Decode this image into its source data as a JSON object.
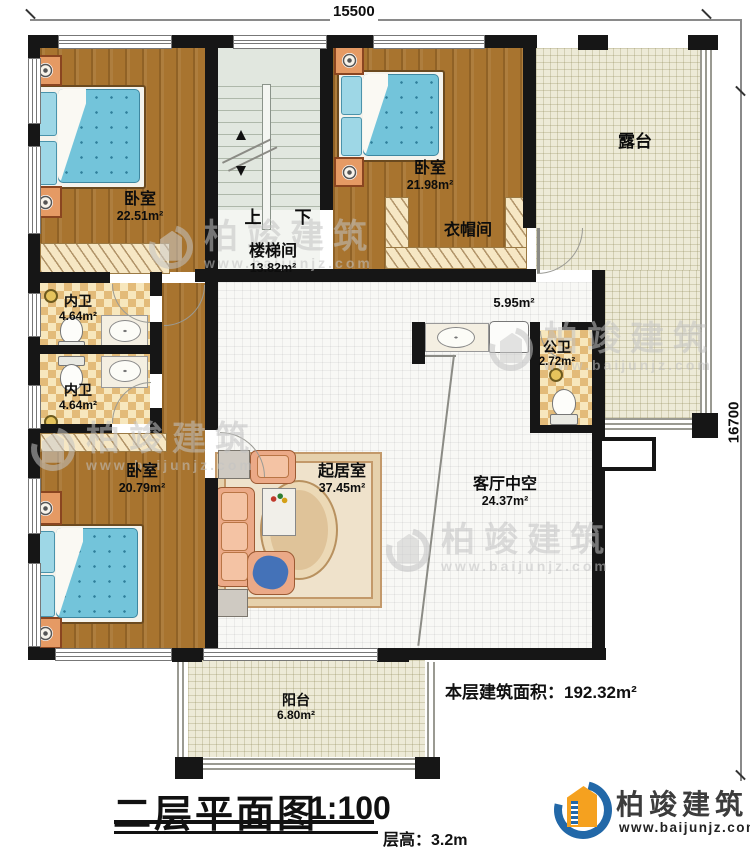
{
  "dimensions": {
    "top": "15500",
    "right": "16700"
  },
  "rooms": {
    "bedroom_tl": {
      "name": "卧室",
      "area": "22.51m²"
    },
    "bedroom_tr": {
      "name": "卧室",
      "area": "21.98m²"
    },
    "closet": {
      "name": "衣帽间"
    },
    "stairwell": {
      "name": "楼梯间",
      "area": "13.82m²",
      "up": "上",
      "down": "下"
    },
    "terrace": {
      "name": "露台"
    },
    "hall": {
      "area": "5.95m²"
    },
    "public_bath": {
      "name": "公卫",
      "area": "2.72m²"
    },
    "bath_1": {
      "name": "内卫",
      "area": "4.64m²"
    },
    "bath_2": {
      "name": "内卫",
      "area": "4.64m²"
    },
    "bedroom_bl": {
      "name": "卧室",
      "area": "20.79m²"
    },
    "living": {
      "name": "起居室",
      "area": "37.45m²"
    },
    "void": {
      "name": "客厅中空",
      "area": "24.37m²"
    },
    "balcony": {
      "name": "阳台",
      "area": "6.80m²"
    }
  },
  "footer": {
    "floor_area_label": "本层建筑面积：192.32m²",
    "title": "二层平面图",
    "scale": "1:100",
    "floor_height": "层高：3.2m"
  },
  "brand": {
    "name": "柏竣建筑",
    "website": "www.baijunjz.com"
  },
  "watermark": {
    "name": "柏竣建筑",
    "website": "www.baijunjz.com"
  },
  "colors": {
    "wall": "#161616",
    "wood_floor": "#a8742f",
    "terrace_floor": "#edead7",
    "bath_tile": "#e3bb79",
    "stair": "#e1e7df",
    "bed_blue": "#73c4da",
    "sofa": "#eba987",
    "brand_blue": "#2268a8",
    "brand_orange": "#f5a11f"
  }
}
